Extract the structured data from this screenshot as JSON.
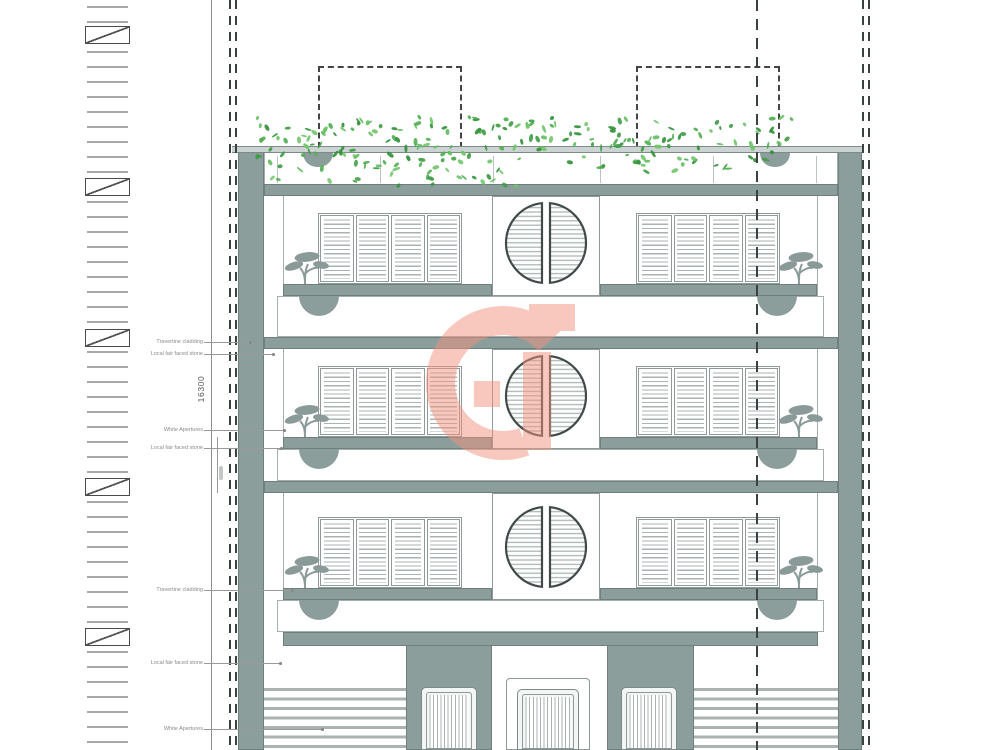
{
  "dimension": {
    "value": "16300"
  },
  "annotations": [
    {
      "label": "Travertine cladding",
      "y": 342,
      "leader_end_x": 250
    },
    {
      "label": "Local fair faced stone",
      "y": 354,
      "leader_end_x": 273
    },
    {
      "label": "White Apertures",
      "y": 430,
      "leader_end_x": 284
    },
    {
      "label": "Local fair faced stone",
      "y": 448,
      "leader_end_x": 281
    },
    {
      "label": "Travertine cladding",
      "y": 590,
      "leader_end_x": 292
    },
    {
      "label": "Local fair faced stone",
      "y": 663,
      "leader_end_x": 280
    },
    {
      "label": "White Apertures",
      "y": 729,
      "leader_end_x": 322
    }
  ],
  "watermark": {
    "letter": "G",
    "color": "rgba(242,146,126,0.5)"
  },
  "colors": {
    "structure": "#8c9e9c",
    "structure_dark": "#6f7f7d",
    "frame": "#8e9998",
    "louvre": "#a9b3b2",
    "light_band": "#ccd4d3",
    "line_faint": "#a7afae",
    "dashed": "#3a4240",
    "ladder": "#a8a8a8",
    "ladder_box": "#4a4a4a",
    "label_text": "#8a8a8a",
    "leader": "#999999",
    "dim_text": "#555555",
    "porthole_ring": "#3f4a49",
    "door_slat": "#a9b2b1",
    "stripe": "#aab3b2",
    "greens": [
      "#4fae4f",
      "#3d9b42",
      "#63bd5f",
      "#2f8f36",
      "#6fc468"
    ]
  }
}
